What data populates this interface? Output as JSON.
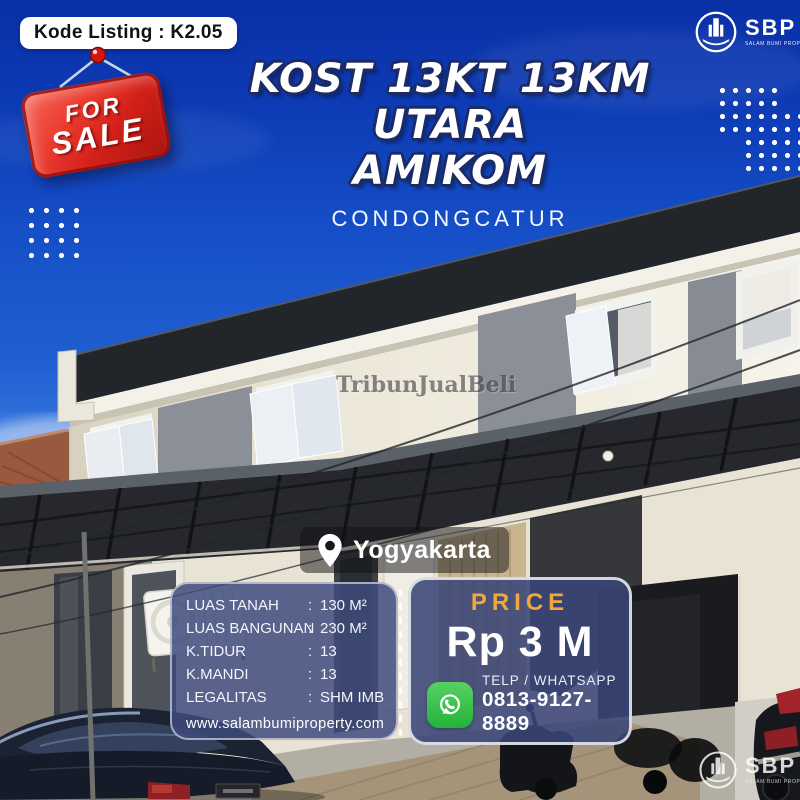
{
  "listing": {
    "code_label": "Kode Listing : K2.05"
  },
  "sale_sign": {
    "line1": "FOR",
    "line2": "SALE"
  },
  "header": {
    "title_line1": "KOST 13KT 13KM UTARA",
    "title_line2": "AMIKOM",
    "subtitle": "CONDONGCATUR"
  },
  "brand": {
    "name": "SBP",
    "tagline": "SALAM BUMI PROPERTY"
  },
  "location": {
    "city": "Yogyakarta"
  },
  "details": {
    "separator": ":",
    "rows": [
      {
        "label": "LUAS TANAH",
        "value": "130 M²"
      },
      {
        "label": "LUAS BANGUNAN",
        "value": "230 M²"
      },
      {
        "label": "K.TIDUR",
        "value": "13"
      },
      {
        "label": "K.MANDI",
        "value": "13"
      },
      {
        "label": "LEGALITAS",
        "value": "SHM IMB"
      }
    ],
    "website": "www.salambumiproperty.com"
  },
  "price": {
    "label": "PRICE",
    "value": "Rp 3 M"
  },
  "contact": {
    "label": "TELP / WHATSAPP",
    "phone": "0813-9127-8889"
  },
  "watermark": {
    "text": "TribunJualBeli"
  },
  "colors": {
    "background_blue": "#1148C0",
    "panel_blue": "#3E4B7D",
    "accent_gold": "#F0A73E",
    "sale_red": "#D21F18",
    "whatsapp_green": "#3FC351"
  }
}
